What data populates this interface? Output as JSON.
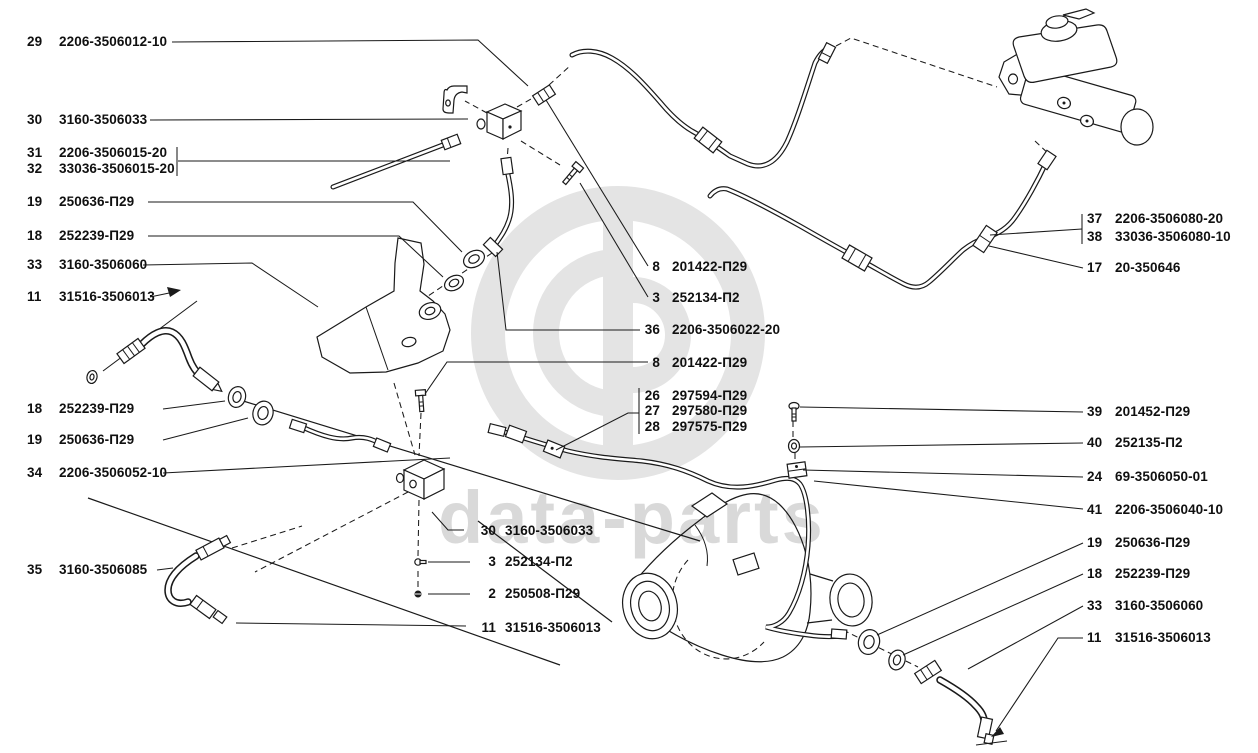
{
  "watermark_text": "data-parts",
  "colors": {
    "line": "#1a1a1a",
    "watermark_gray": "#e4e4e4",
    "watermark_text_gray": "#d9d9d9",
    "label_text": "#101010"
  },
  "callouts": {
    "left": [
      {
        "num": "29",
        "code": "2206-3506012-10"
      },
      {
        "num": "30",
        "code": "3160-3506033"
      },
      {
        "num": "31",
        "code": "2206-3506015-20"
      },
      {
        "num": "32",
        "code": "33036-3506015-20"
      },
      {
        "num": "19",
        "code": "250636-П29"
      },
      {
        "num": "18",
        "code": "252239-П29"
      },
      {
        "num": "33",
        "code": "3160-3506060"
      },
      {
        "num": "11",
        "code": "31516-3506013"
      },
      {
        "num": "18",
        "code": "252239-П29"
      },
      {
        "num": "19",
        "code": "250636-П29"
      },
      {
        "num": "34",
        "code": "2206-3506052-10"
      },
      {
        "num": "35",
        "code": "3160-3506085"
      }
    ],
    "middle": [
      {
        "num": "8",
        "code": "201422-П29"
      },
      {
        "num": "3",
        "code": "252134-П2"
      },
      {
        "num": "36",
        "code": "2206-3506022-20"
      },
      {
        "num": "8",
        "code": "201422-П29"
      },
      {
        "num": "26",
        "code": "297594-П29"
      },
      {
        "num": "27",
        "code": "297580-П29"
      },
      {
        "num": "28",
        "code": "297575-П29"
      }
    ],
    "middle_bottom": [
      {
        "num": "30",
        "code": "3160-3506033"
      },
      {
        "num": "3",
        "code": "252134-П2"
      },
      {
        "num": "2",
        "code": "250508-П29"
      },
      {
        "num": "11",
        "code": "31516-3506013"
      }
    ],
    "right": [
      {
        "num": "37",
        "code": "2206-3506080-20"
      },
      {
        "num": "38",
        "code": "33036-3506080-10"
      },
      {
        "num": "17",
        "code": "20-350646"
      },
      {
        "num": "39",
        "code": "201452-П29"
      },
      {
        "num": "40",
        "code": "252135-П2"
      },
      {
        "num": "24",
        "code": "69-3506050-01"
      },
      {
        "num": "41",
        "code": "2206-3506040-10"
      },
      {
        "num": "19",
        "code": "250636-П29"
      },
      {
        "num": "18",
        "code": "252239-П29"
      },
      {
        "num": "33",
        "code": "3160-3506060"
      },
      {
        "num": "11",
        "code": "31516-3506013"
      }
    ]
  }
}
